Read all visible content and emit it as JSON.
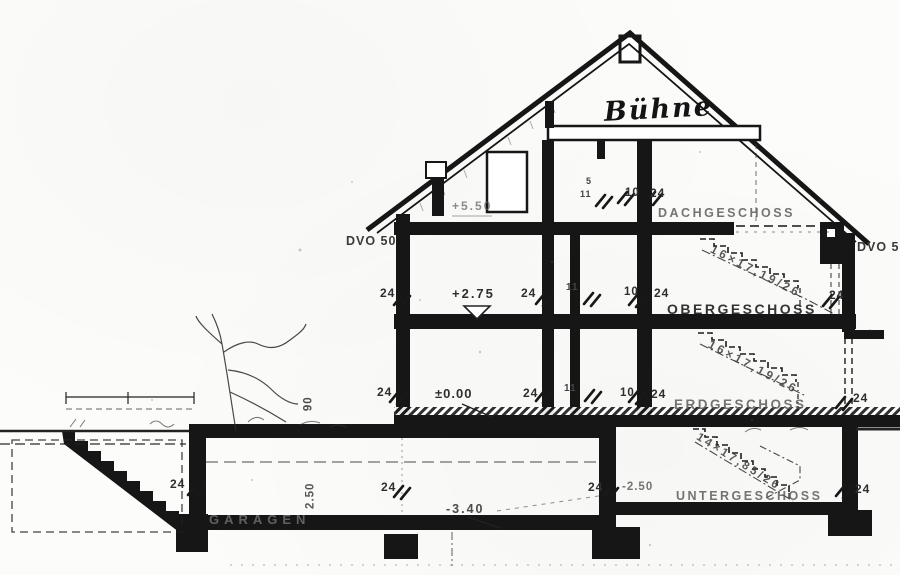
{
  "drawing": {
    "handwritten_title": "Bühne",
    "floor_labels": {
      "dachgeschoss": "DACHGESCHOSS",
      "obergeschoss": "OBERGESCHOSS",
      "erdgeschoss": "ERDGESCHOSS",
      "untergeschoss": "UNTERGESCHOSS",
      "garagen": "GARAGEN"
    },
    "levels": {
      "dach_floor": "+5.50",
      "ober_floor": "+2.75",
      "erd_floor": "±0.00",
      "unter_floor": "-2.50",
      "garage_floor": "-3.40"
    },
    "gutters": {
      "left": "DVO 50",
      "right": "DVO 50"
    },
    "stair_annotations": {
      "flight_dach": "16×17,19/26",
      "flight_ober": "16×17,19/26",
      "flight_unter": "14×17,85/26"
    },
    "dimensions": {
      "wall_24": "24",
      "wall_10": "10",
      "wall_11": "11",
      "wall_5": "5",
      "garage_height": "2.50",
      "parapet_height": "90"
    },
    "ink_color": "#161616"
  }
}
